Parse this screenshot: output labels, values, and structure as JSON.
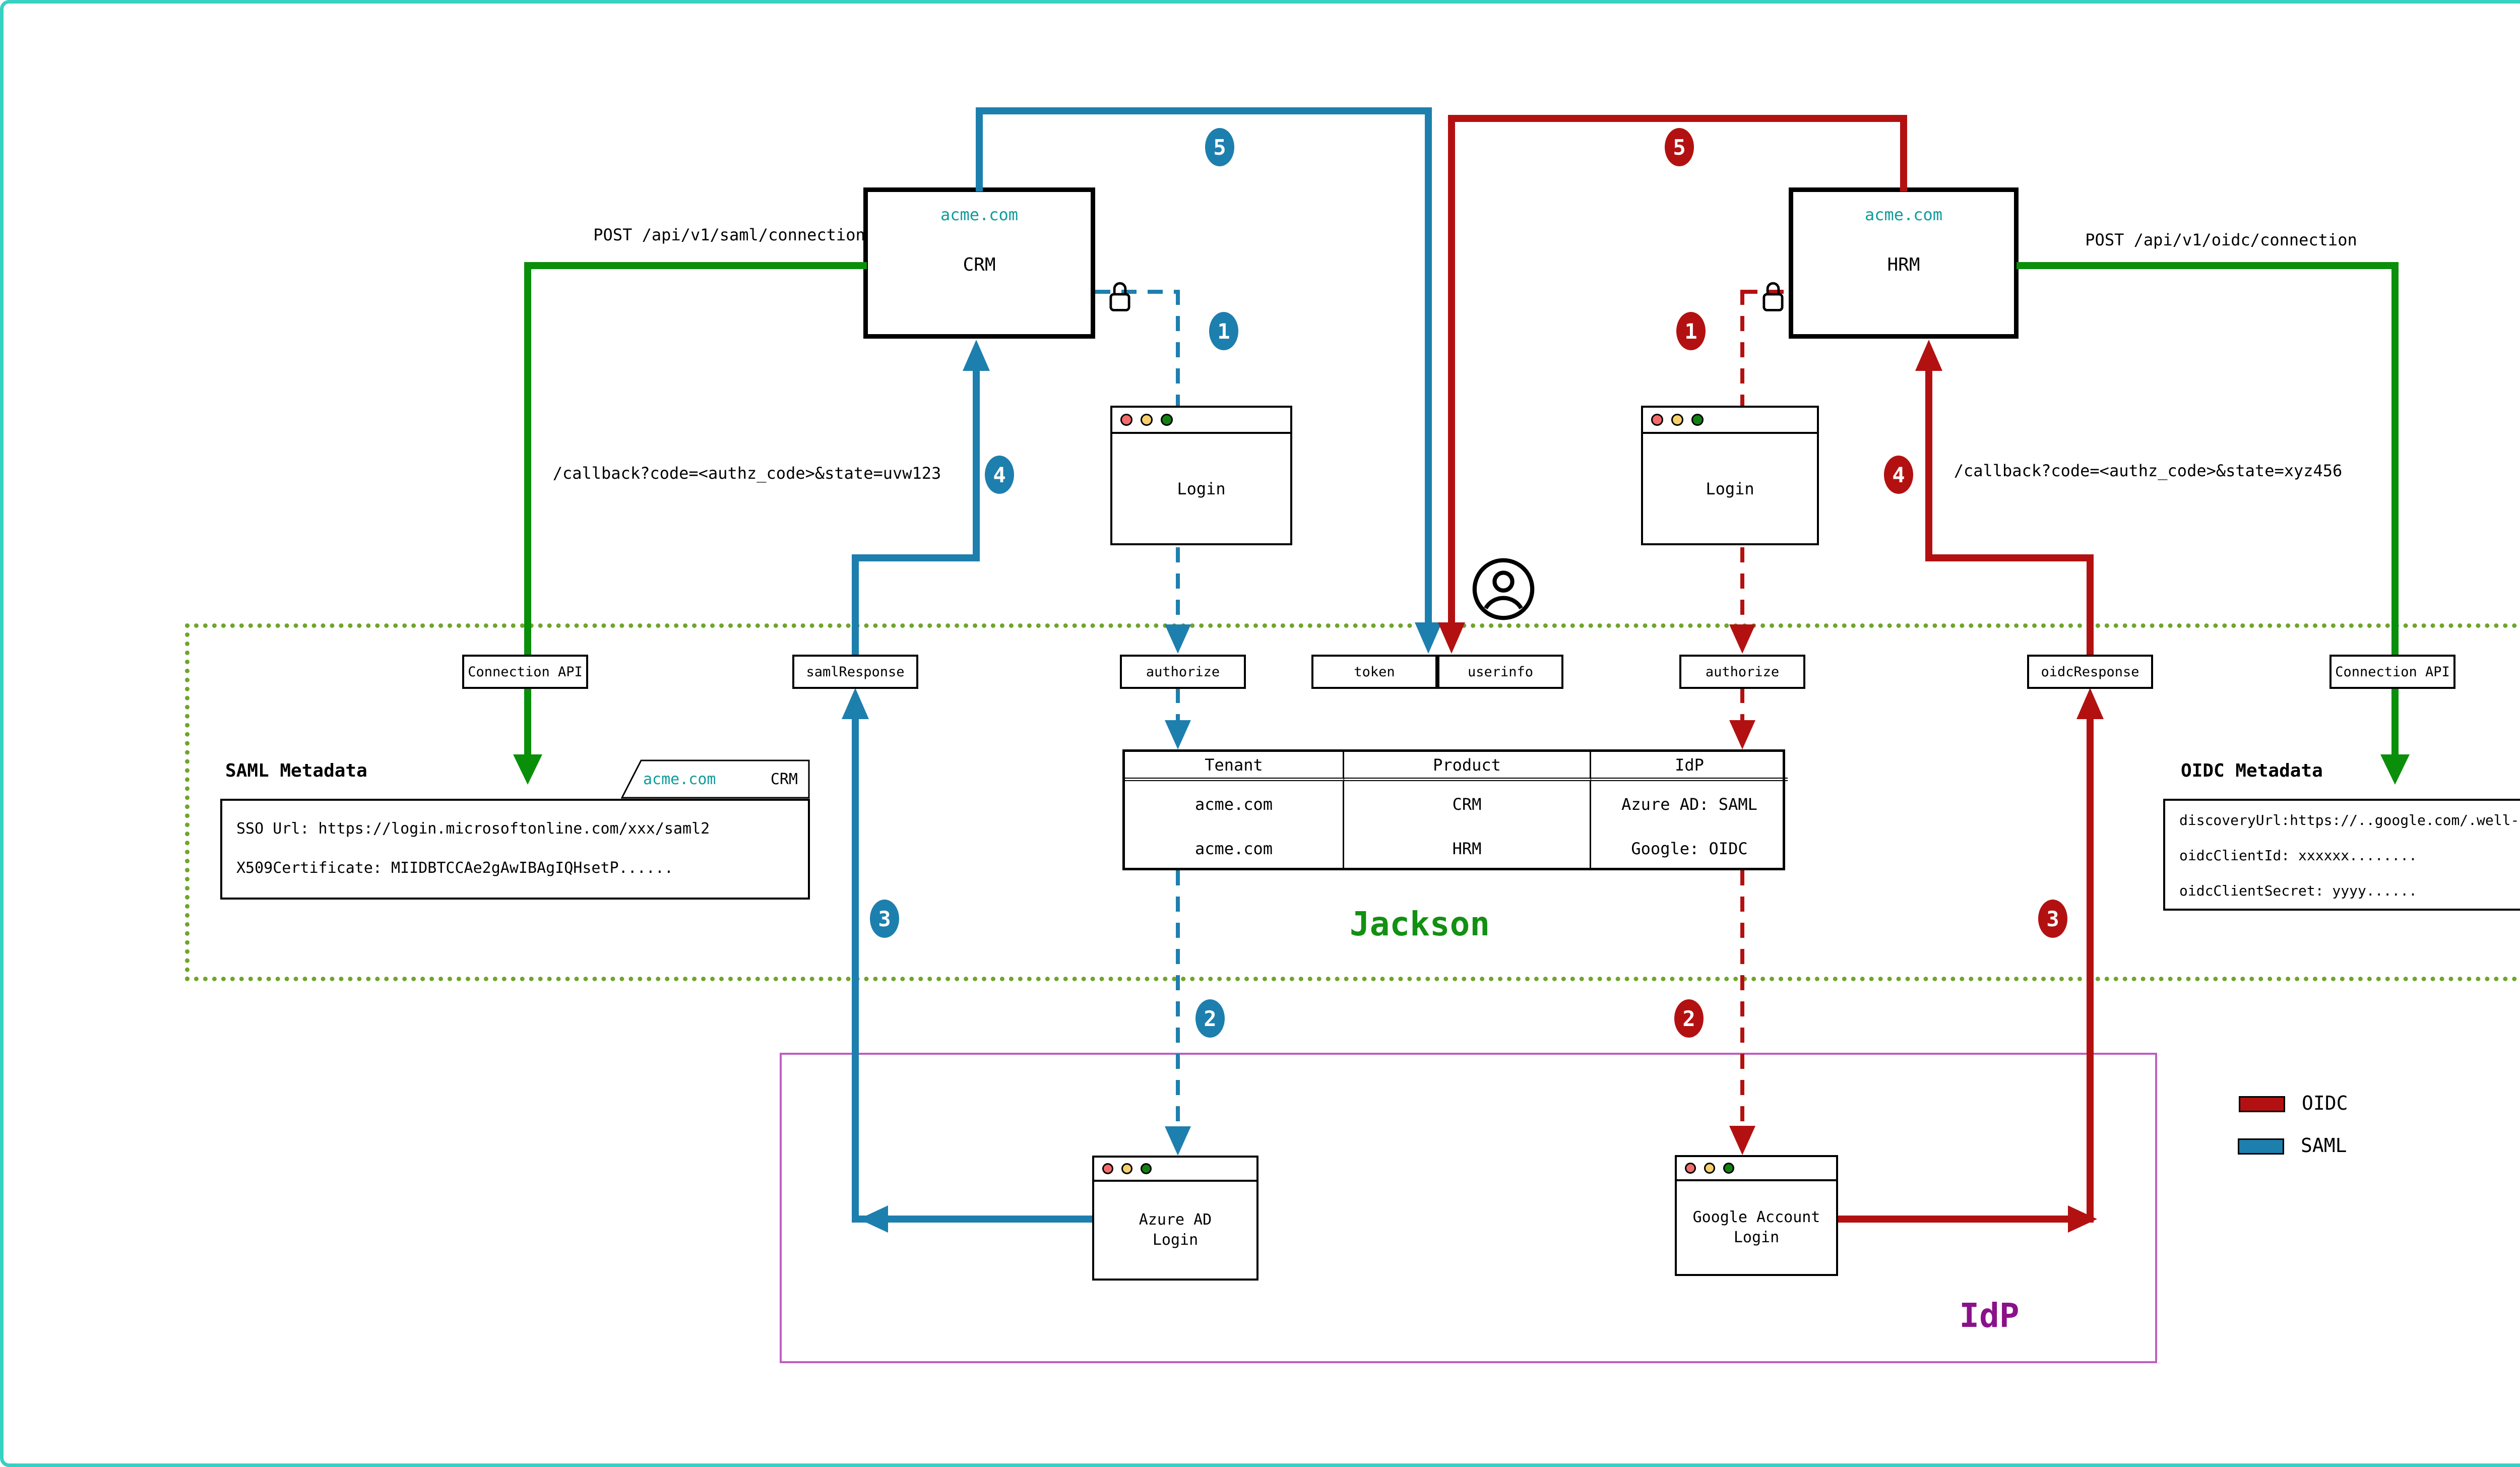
{
  "palette": {
    "frame_teal": "#35d1c3",
    "saml_blue": "#1d7fae",
    "oidc_red": "#b31111",
    "flow_green": "#0a8f0a",
    "jackson_border_green": "#6fa52a",
    "jackson_label_green": "#129012",
    "idp_border_purple": "#c05ec0",
    "idp_label_purple": "#8b118b",
    "domain_teal": "#0f9b9b"
  },
  "apps": {
    "crm": {
      "domain": "acme.com",
      "name": "CRM"
    },
    "hrm": {
      "domain": "acme.com",
      "name": "HRM"
    }
  },
  "api_calls": {
    "saml": "POST /api/v1/saml/connection",
    "oidc": "POST /api/v1/oidc/connection"
  },
  "callbacks": {
    "saml": "/callback?code=<authz_code>&state=uvw123",
    "oidc": "/callback?code=<authz_code>&state=xyz456"
  },
  "steps": [
    "1",
    "2",
    "3",
    "4",
    "5"
  ],
  "jackson": {
    "label": "Jackson",
    "endpoints": [
      "Connection API",
      "samlResponse",
      "authorize",
      "token",
      "userinfo",
      "authorize",
      "oidcResponse",
      "Connection API"
    ]
  },
  "idp": {
    "label": "IdP"
  },
  "windows": {
    "login": "Login",
    "azure": {
      "line1": "Azure AD",
      "line2": "Login"
    },
    "google": {
      "line1": "Google Account",
      "line2": "Login"
    }
  },
  "connections_table": {
    "headers": [
      "Tenant",
      "Product",
      "IdP"
    ],
    "rows": [
      [
        "acme.com",
        "CRM",
        "Azure AD: SAML"
      ],
      [
        "acme.com",
        "HRM",
        "Google: OIDC"
      ]
    ]
  },
  "docs": {
    "saml": {
      "title": "SAML Metadata",
      "tab": {
        "domain": "acme.com",
        "app": "CRM"
      },
      "lines": [
        "SSO Url: https://login.microsoftonline.com/xxx/saml2",
        "X509Certificate: MIIDBTCCAe2gAwIBAgIQHsetP......"
      ]
    },
    "oidc": {
      "title": "OIDC Metadata",
      "tab": {
        "domain": "acme.com",
        "app": "HRM"
      },
      "lines": [
        "discoveryUrl:https://..google.com/.well-known/openid-configuration",
        "oidcClientId: xxxxxx........",
        "oidcClientSecret: yyyy......"
      ]
    }
  },
  "legend": {
    "items": [
      {
        "label": "OIDC",
        "color": "#b31111"
      },
      {
        "label": "SAML",
        "color": "#1d7fae"
      }
    ]
  },
  "icons": {
    "lock": "lock-icon",
    "user": "person-icon",
    "window_dots": [
      "close",
      "minimize",
      "maximize"
    ]
  }
}
